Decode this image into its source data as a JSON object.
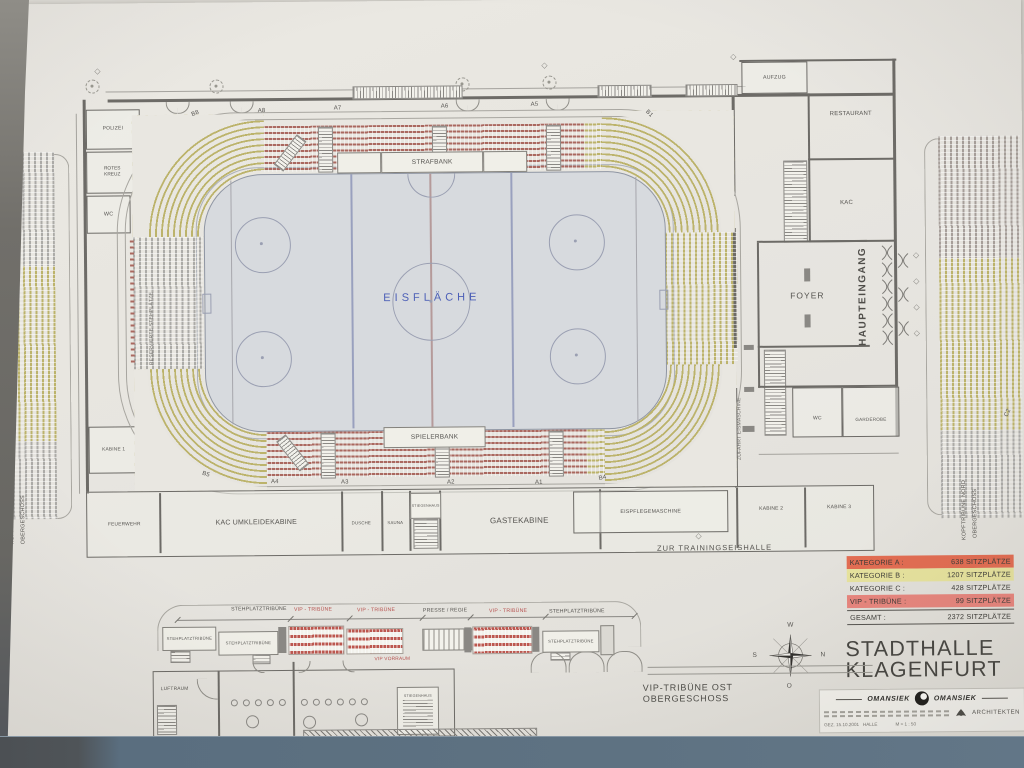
{
  "colors": {
    "paper": "#ebe9e3",
    "wall": "#d8d6d0",
    "frame_left_dark": "#6e6d68",
    "frame_bottom": "#5d7181",
    "ink": "#55534f",
    "ice_fill": "#d9dce0",
    "ice_line_blue": "#99a1c2",
    "ice_text": "#4a5fc0",
    "seat_red": "#b0665c",
    "seat_yellow": "#beb464",
    "seat_gray": "#adaca8",
    "legend_a_highlight": "#ec6a4d",
    "legend_b_highlight": "#e9e498",
    "legend_vip_highlight": "#f0837a",
    "red_text": "#c0504d"
  },
  "title": {
    "line1": "STADTHALLE",
    "line2": "KLAGENFURT"
  },
  "legend": {
    "rows": [
      {
        "label": "KATEGORIE A :",
        "value": "638 SITZPLÄTZE",
        "highlight": "#ec6a4d"
      },
      {
        "label": "KATEGORIE B :",
        "value": "1207 SITZPLÄTZE",
        "highlight": "#e9e498"
      },
      {
        "label": "KATEGORIE C :",
        "value": "428 SITZPLÄTZE",
        "highlight": "transparent"
      },
      {
        "label": "VIP - TRIBÜNE :",
        "value": "99 SITZPLÄTZE",
        "highlight": "#f0837a"
      },
      {
        "label": "GESAMT :",
        "value": "2372 SITZPLÄTZE",
        "highlight": "transparent"
      }
    ]
  },
  "rink": {
    "label": "EISFLÄCHE",
    "strafbank": "STRAFBANK",
    "spielerbank": "SPIELERBANK"
  },
  "sections": {
    "b8": "B8",
    "a8": "A8",
    "a7": "A7",
    "a6": "A6",
    "a5": "A5",
    "b1": "B1",
    "b5": "B5",
    "a4": "A4",
    "a3": "A3",
    "a2": "A2",
    "a1": "A1",
    "b4": "B4",
    "c2": "C2"
  },
  "rooms": {
    "polizei": "POLIZEI",
    "rotes_kreuz": "ROTES KREUZ",
    "wc_left": "WC",
    "kabine1": "KABINE 1",
    "feuerwehr": "FEUERWEHR",
    "kac_umkleidekabine": "KAC UMKLEIDEKABINE",
    "dusche": "DUSCHE",
    "sauna": "SAUNA",
    "stiegenhaus": "STIEGENHAUS",
    "gaestekabine": "GASTEKABINE",
    "eispflegemaschine": "EISPFLEGEMASCHINE",
    "kabine2": "KABINE 2",
    "kabine3": "KABINE 3",
    "aufzug": "AUFZUG",
    "restaurant": "RESTAURANT",
    "kac": "KAC",
    "foyer": "FOYER",
    "haupteingang": "HAUPTEINGANG",
    "wc_right": "WC",
    "garderobe": "GARDEROBE"
  },
  "annotations": {
    "zur_trainingseishalle": "ZUR TRAININGSEISHALLE",
    "reservierte_stehplaetze": "RESERVIERTE STEHPLÄTZE",
    "zufahrt_eismaschine": "ZUFAHRT EISMASCHINE",
    "tribuene_sued_line1": "KOPFTRIBÜNE SÜD",
    "tribuene_sued_line2": "OBERGESCHOSS",
    "tribuene_nord_line1": "KOPFTRIBÜNE NORD",
    "tribuene_nord_line2": "OBERGESCHOSS"
  },
  "compass": {
    "w": "W",
    "n": "N",
    "o": "O",
    "s": "S"
  },
  "inset": {
    "caption_line1": "VIP-TRIBÜNE OST",
    "caption_line2": "OBERGESCHOSS",
    "dim_labels": [
      {
        "text": "STEHPLATZTRIBÜNE",
        "red": false
      },
      {
        "text": "VIP - TRIBÜNE",
        "red": true
      },
      {
        "text": "VIP - TRIBÜNE",
        "red": true
      },
      {
        "text": "PRESSE / REGIE",
        "red": false
      },
      {
        "text": "VIP - TRIBÜNE",
        "red": true
      },
      {
        "text": "STEHPLATZTRIBÜNE",
        "red": false
      }
    ],
    "platform_label_1": "STEHPLATZTRIBÜNE",
    "platform_label_2": "STEHPLATZTRIBÜNE",
    "platform_label_3": "STEHPLATZTRIBÜNE",
    "vip_vorraum": "VIP VORRAUM",
    "luftraum": "LUFTRAUM",
    "stiegenhaus": "STIEGENHAUS"
  },
  "stamp": {
    "firm_left": "OMANSIEK",
    "firm_right": "OMANSIEK",
    "profession": "ARCHITEKTEN",
    "note": "GEZ. 15.10.2001   HALLE",
    "scale": "M = 1 : 50"
  }
}
